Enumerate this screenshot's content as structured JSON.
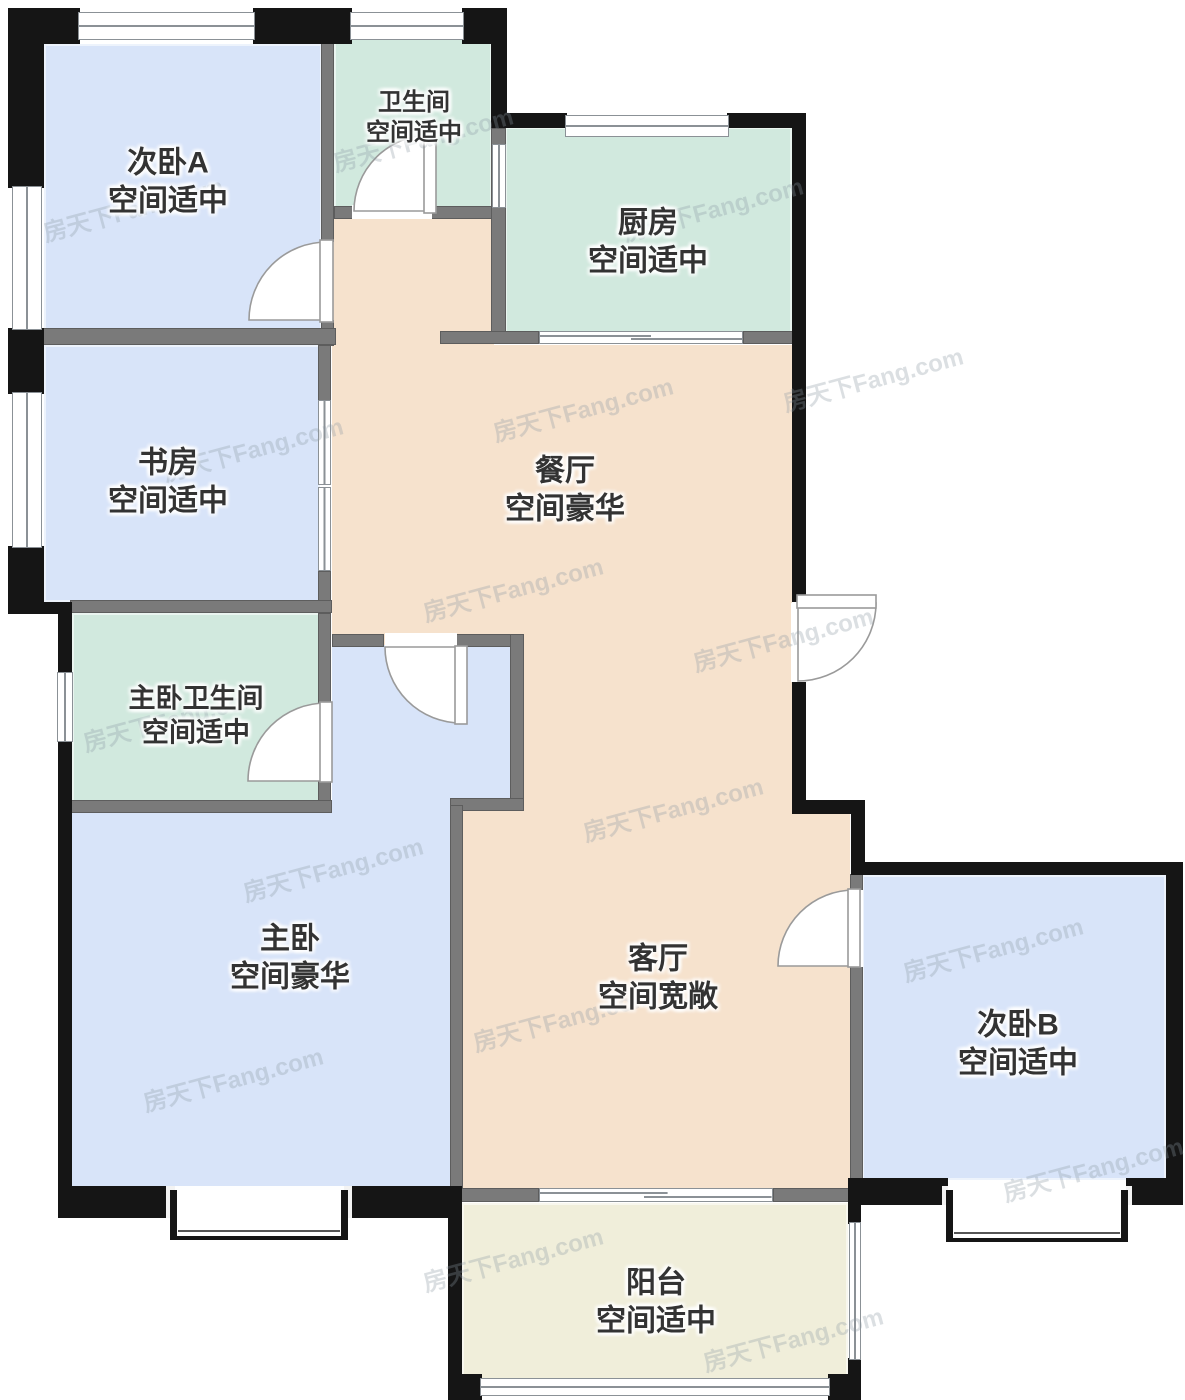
{
  "title": "户型图",
  "watermark": {
    "text": "房天下Fang.com"
  },
  "rooms": [
    {
      "id": "bedroom-a",
      "name": "次卧A",
      "quality": "空间适中"
    },
    {
      "id": "bathroom",
      "name": "卫生间",
      "quality": "空间适中"
    },
    {
      "id": "kitchen",
      "name": "厨房",
      "quality": "空间适中"
    },
    {
      "id": "study",
      "name": "书房",
      "quality": "空间适中"
    },
    {
      "id": "dining",
      "name": "餐厅",
      "quality": "空间豪华"
    },
    {
      "id": "master-bathroom",
      "name": "主卧卫生间",
      "quality": "空间适中"
    },
    {
      "id": "master-bedroom",
      "name": "主卧",
      "quality": "空间豪华"
    },
    {
      "id": "living",
      "name": "客厅",
      "quality": "空间宽敞"
    },
    {
      "id": "bedroom-b",
      "name": "次卧B",
      "quality": "空间适中"
    },
    {
      "id": "balcony",
      "name": "阳台",
      "quality": "空间适中"
    }
  ],
  "colors": {
    "blue": "#d8e4f9",
    "green": "#d1e9de",
    "beige": "#f6e2cd",
    "balcony": "#f0eeda",
    "wall": "#151515",
    "partition": "#7a7a7a",
    "frame": "#8b9196",
    "label": "#333333",
    "watermark": "#8c99a3"
  }
}
